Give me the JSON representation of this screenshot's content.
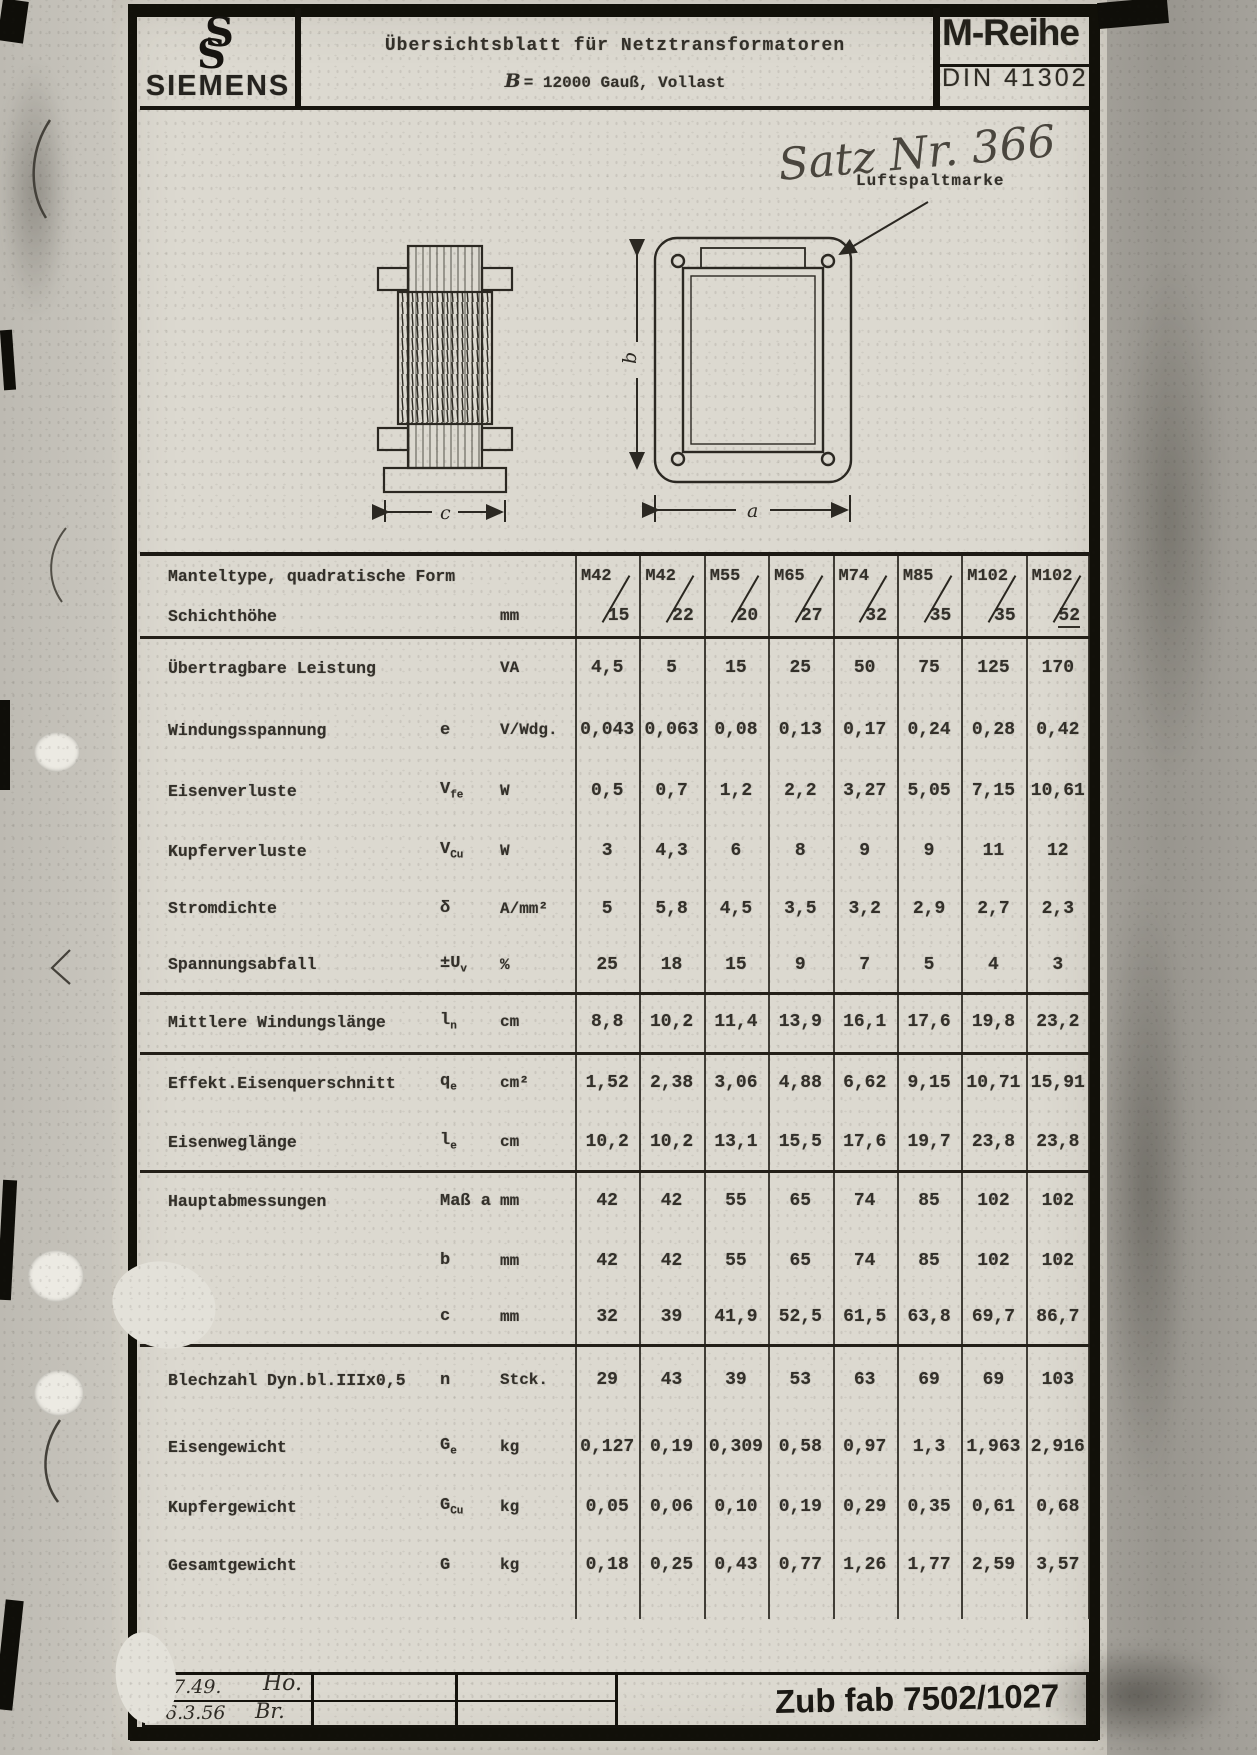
{
  "header": {
    "brand": "SIEMENS",
    "title": "Übersichtsblatt für Netztransformatoren",
    "subtitle_symbol": "B",
    "subtitle": "= 12000 Gauß, Vollast",
    "series": "M-Reihe",
    "din": "DIN 41302"
  },
  "notes": {
    "handwritten": "Satz Nr. 366",
    "airgap": "Luftspaltmarke"
  },
  "figure": {
    "dim_a": "a",
    "dim_b": "b",
    "dim_c": "c"
  },
  "table": {
    "type_label": "Manteltype, quadratische Form",
    "height_label": "Schichthöhe",
    "height_unit": "mm",
    "columns": [
      {
        "type": "M42",
        "height": "15"
      },
      {
        "type": "M42",
        "height": "22"
      },
      {
        "type": "M55",
        "height": "20"
      },
      {
        "type": "M65",
        "height": "27"
      },
      {
        "type": "M74",
        "height": "32"
      },
      {
        "type": "M85",
        "height": "35"
      },
      {
        "type": "M102",
        "height": "35"
      },
      {
        "type": "M102",
        "height": "52"
      }
    ],
    "rows": [
      {
        "label": "Übertragbare Leistung",
        "sym": "",
        "sub": "",
        "unit": "VA",
        "values": [
          "4,5",
          "5",
          "15",
          "25",
          "50",
          "75",
          "125",
          "170"
        ],
        "sep": false
      },
      {
        "label": "Windungsspannung",
        "sym": "e",
        "sub": "",
        "unit": "V/Wdg.",
        "values": [
          "0,043",
          "0,063",
          "0,08",
          "0,13",
          "0,17",
          "0,24",
          "0,28",
          "0,42"
        ],
        "sep": false
      },
      {
        "label": "Eisenverluste",
        "sym": "V",
        "sub": "fe",
        "unit": "W",
        "values": [
          "0,5",
          "0,7",
          "1,2",
          "2,2",
          "3,27",
          "5,05",
          "7,15",
          "10,61"
        ],
        "sep": false
      },
      {
        "label": "Kupferverluste",
        "sym": "V",
        "sub": "Cu",
        "unit": "W",
        "values": [
          "3",
          "4,3",
          "6",
          "8",
          "9",
          "9",
          "11",
          "12"
        ],
        "sep": false
      },
      {
        "label": "Stromdichte",
        "sym": "δ",
        "sub": "",
        "unit": "A/mm²",
        "values": [
          "5",
          "5,8",
          "4,5",
          "3,5",
          "3,2",
          "2,9",
          "2,7",
          "2,3"
        ],
        "sep": false
      },
      {
        "label": "Spannungsabfall",
        "sym": "±U",
        "sub": "v",
        "unit": "%",
        "values": [
          "25",
          "18",
          "15",
          "9",
          "7",
          "5",
          "4",
          "3"
        ],
        "sep": true
      },
      {
        "label": "Mittlere Windungslänge",
        "sym": "l",
        "sub": "n",
        "unit": "cm",
        "values": [
          "8,8",
          "10,2",
          "11,4",
          "13,9",
          "16,1",
          "17,6",
          "19,8",
          "23,2"
        ],
        "sep": true
      },
      {
        "label": "Effekt.Eisenquerschnitt",
        "sym": "q",
        "sub": "e",
        "unit": "cm²",
        "values": [
          "1,52",
          "2,38",
          "3,06",
          "4,88",
          "6,62",
          "9,15",
          "10,71",
          "15,91"
        ],
        "sep": false
      },
      {
        "label": "Eisenweglänge",
        "sym": "l",
        "sub": "e",
        "unit": "cm",
        "values": [
          "10,2",
          "10,2",
          "13,1",
          "15,5",
          "17,6",
          "19,7",
          "23,8",
          "23,8"
        ],
        "sep": true
      },
      {
        "label": "Hauptabmessungen",
        "sym": "Maß a",
        "sub": "",
        "unit": "mm",
        "values": [
          "42",
          "42",
          "55",
          "65",
          "74",
          "85",
          "102",
          "102"
        ],
        "sep": false
      },
      {
        "label": "",
        "sym": "b",
        "sub": "",
        "unit": "mm",
        "values": [
          "42",
          "42",
          "55",
          "65",
          "74",
          "85",
          "102",
          "102"
        ],
        "sep": false
      },
      {
        "label": "",
        "sym": "c",
        "sub": "",
        "unit": "mm",
        "values": [
          "32",
          "39",
          "41,9",
          "52,5",
          "61,5",
          "63,8",
          "69,7",
          "86,7"
        ],
        "sep": true
      },
      {
        "label": "Blechzahl Dyn.bl.IIIx0,5",
        "sym": "n",
        "sub": "",
        "unit": "Stck.",
        "values": [
          "29",
          "43",
          "39",
          "53",
          "63",
          "69",
          "69",
          "103"
        ],
        "sep": false
      },
      {
        "label": "Eisengewicht",
        "sym": "G",
        "sub": "e",
        "unit": "kg",
        "values": [
          "0,127",
          "0,19",
          "0,309",
          "0,58",
          "0,97",
          "1,3",
          "1,963",
          "2,916"
        ],
        "sep": false
      },
      {
        "label": "Kupfergewicht",
        "sym": "G",
        "sub": "Cu",
        "unit": "kg",
        "values": [
          "0,05",
          "0,06",
          "0,10",
          "0,19",
          "0,29",
          "0,35",
          "0,61",
          "0,68"
        ],
        "sep": false
      },
      {
        "label": "Gesamtgewicht",
        "sym": "G",
        "sub": "",
        "unit": "kg",
        "values": [
          "0,18",
          "0,25",
          "0,43",
          "0,77",
          "1,26",
          "1,77",
          "2,59",
          "3,57"
        ],
        "sep": false
      }
    ]
  },
  "footer": {
    "date1": "1.7.49.",
    "sig1": "Hö.",
    "date2": "16.3.56",
    "sig2": "Br.",
    "stamp": "Zub fab 7502/1027"
  }
}
